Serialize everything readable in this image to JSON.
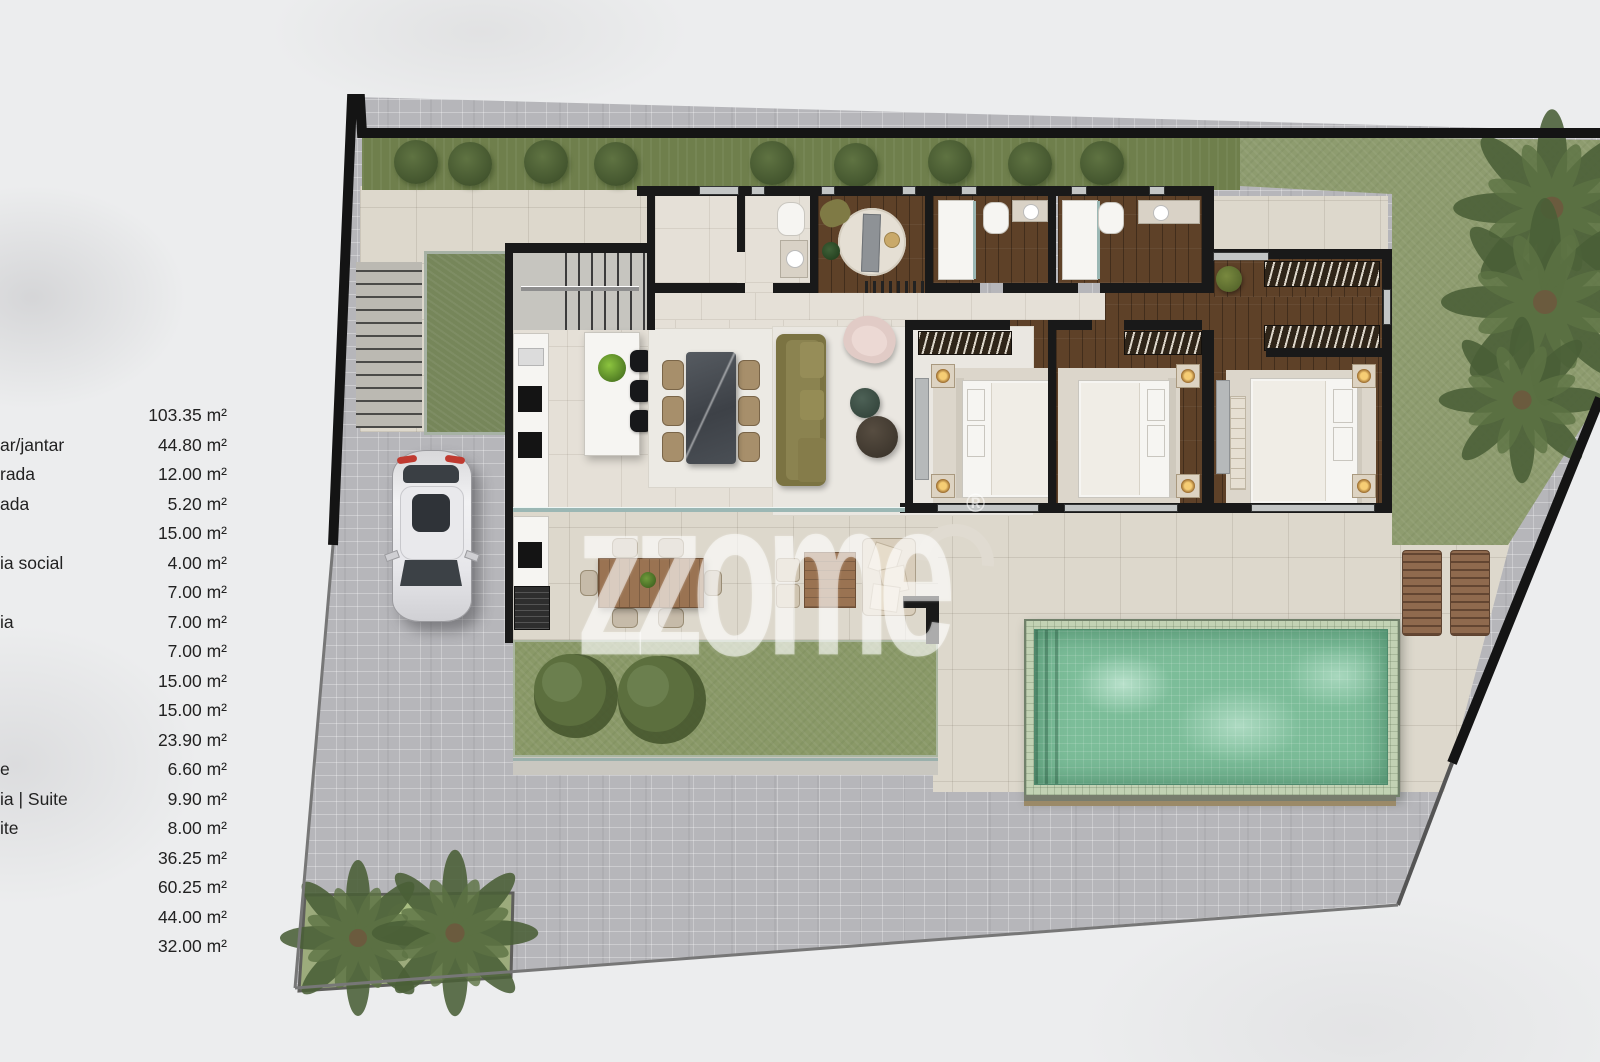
{
  "watermark": {
    "text": "zzome",
    "registered": "®"
  },
  "area_table": {
    "rows": [
      {
        "label": "",
        "value": "103.35 m²"
      },
      {
        "label": "ar/jantar",
        "value": "44.80 m²"
      },
      {
        "label": "rada",
        "value": "12.00 m²"
      },
      {
        "label": "ada",
        "value": "5.20 m²"
      },
      {
        "label": "",
        "value": "15.00 m²"
      },
      {
        "label": "ia social",
        "value": "4.00 m²"
      },
      {
        "label": "",
        "value": "7.00 m²"
      },
      {
        "label": "ia",
        "value": "7.00 m²"
      },
      {
        "label": "",
        "value": "7.00 m²"
      },
      {
        "label": "",
        "value": "15.00 m²"
      },
      {
        "label": "",
        "value": "15.00 m²"
      },
      {
        "label": "",
        "value": "23.90 m²"
      },
      {
        "label": "e",
        "value": "6.60 m²"
      },
      {
        "label": "ia | Suite",
        "value": "9.90 m²"
      },
      {
        "label": "ite",
        "value": "8.00 m²"
      },
      {
        "label": "",
        "value": "36.25 m²"
      },
      {
        "label": "",
        "value": "60.25 m²"
      },
      {
        "label": "",
        "value": "44.00 m²"
      },
      {
        "label": "",
        "value": "32.00 m²"
      }
    ]
  },
  "palette": {
    "wall": "#191919",
    "cobblestone": "#b6b6ba",
    "paving": "#ddd8cc",
    "interior_tile": "#e5e0d7",
    "wood_floor": "#5e4128",
    "hedge_green": "#6f7f4c",
    "lawn_green": "#8e9c6f",
    "pool_water": "#7cbd99",
    "pool_rim": "#c2d2b4",
    "sofa_olive": "#7b7342",
    "armchair_pink": "#e1cbc6"
  }
}
